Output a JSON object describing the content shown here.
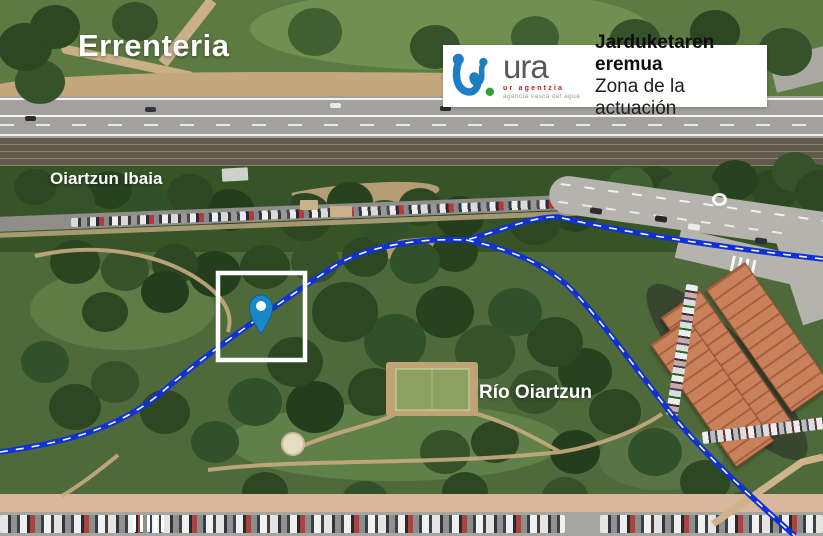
{
  "map": {
    "title": "Errenteria",
    "labels": {
      "oiartzun_ibaia": "Oiartzun Ibaia",
      "rio_oiartzun": "Río Oiartzun"
    },
    "annotation": {
      "highlight_box": "white square outline",
      "marker": "location-pin"
    }
  },
  "legend": {
    "logo_word": "ura",
    "logo_tagline_eu": "ur agentzia",
    "logo_tagline_es": "agencia vasca del agua",
    "title_eu": "Jarduketaren eremua",
    "title_es": "Zona de la actuación"
  },
  "colors": {
    "river_line": "#1031d6",
    "river_centerline": "#ffffff",
    "highlight_box": "#ffffff",
    "pin_fill": "#1b86ca",
    "logo_blue": "#1d7fc1",
    "logo_green": "#2da135",
    "logo_red": "#b22025",
    "logo_gray": "#58595b"
  }
}
